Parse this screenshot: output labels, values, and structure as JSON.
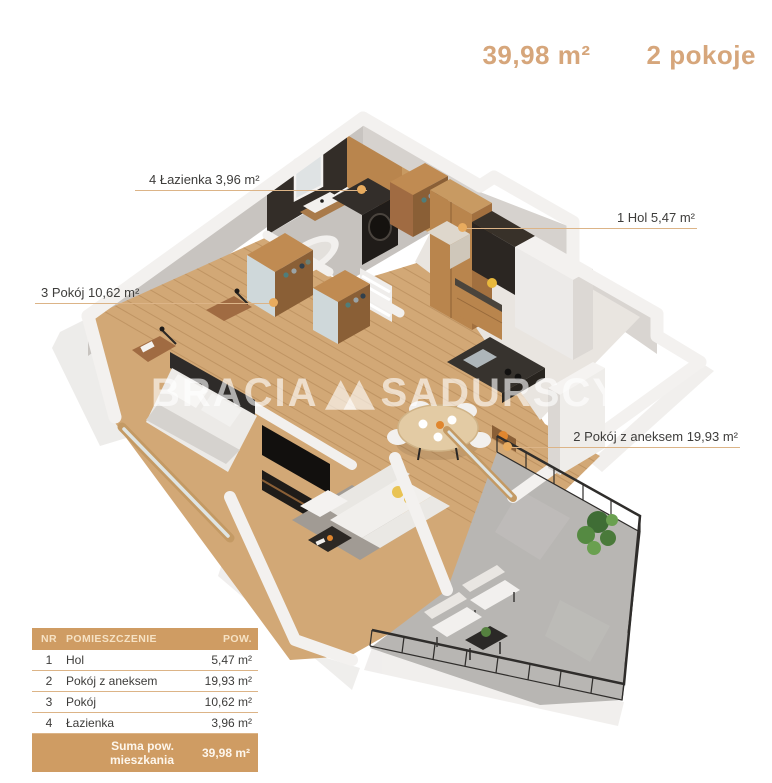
{
  "header": {
    "area_total": "39,98 m²",
    "rooms_count": "2 pokoje"
  },
  "watermark": {
    "brand_left": "BRACIA",
    "brand_right": "SADURSCY"
  },
  "labels": [
    {
      "id": "lazienka",
      "text": "4 Łazienka 3,96 m²"
    },
    {
      "id": "hol",
      "text": "1 Hol 5,47 m²"
    },
    {
      "id": "pokoj",
      "text": "3 Pokój 10,62 m²"
    },
    {
      "id": "pokoj_aneks",
      "text": "2 Pokój z aneksem 19,93 m²"
    }
  ],
  "table": {
    "headers": {
      "nr": "NR",
      "name": "POMIESZCZENIE",
      "area": "POW."
    },
    "rows": [
      {
        "nr": "1",
        "name": "Hol",
        "area": "5,47 m²"
      },
      {
        "nr": "2",
        "name": "Pokój z aneksem",
        "area": "19,93 m²"
      },
      {
        "nr": "3",
        "name": "Pokój",
        "area": "10,62 m²"
      },
      {
        "nr": "4",
        "name": "Łazienka",
        "area": "3,96 m²"
      }
    ],
    "footer": {
      "label": "Suma pow. mieszkania",
      "value": "39,98 m²"
    }
  },
  "colors": {
    "accent": "#cf9c63",
    "leader_line": "#dcb487",
    "leader_dot": "#e8ab5e",
    "header_text": "#d6a67b",
    "wood_floor": "#d2a876",
    "dark_wall": "#332d28"
  }
}
